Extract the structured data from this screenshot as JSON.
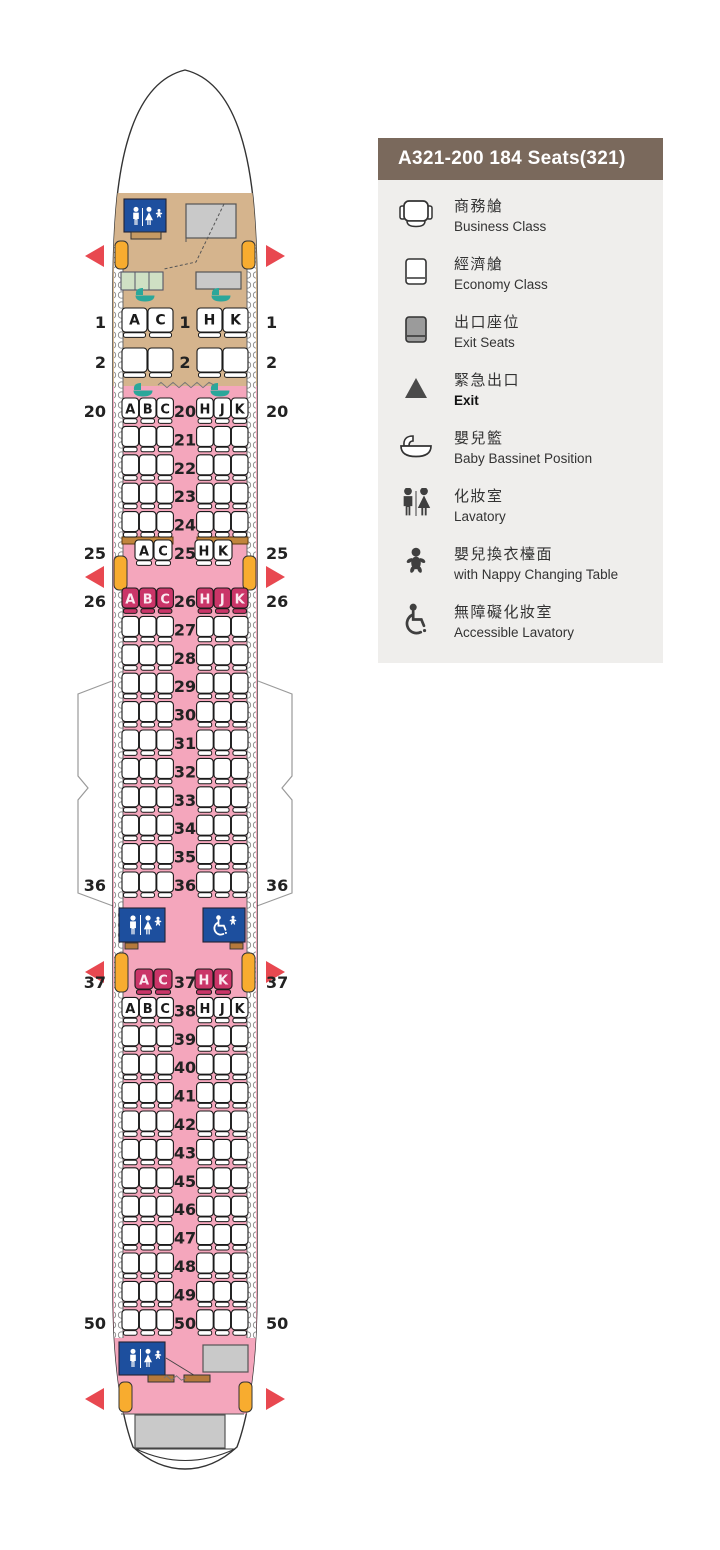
{
  "header": {
    "title": "A321-200 184 Seats(321)"
  },
  "colors": {
    "header_bg": "#7a695c",
    "legend_bg": "#efeeec",
    "pink": "#f4a6bc",
    "magenta": "#ca3568",
    "magenta_letter": "#fbe9f0",
    "tan": "#d5b48d",
    "tan_shelf": "#c59a63",
    "blue": "#1d4f9e",
    "orange": "#f8ac2f",
    "red": "#e84850",
    "teal": "#2ba79a",
    "green": "#cfe0c4",
    "gray": "#c9c9c9",
    "exit_seat_gray": "#9b9b9b",
    "brown_bar": "#b5793b",
    "bulkhead": "#c1853c",
    "outline": "#333333",
    "seat_stroke": "#1a1a1a",
    "number": "#222222",
    "wing": "#9a9a9a",
    "wall": "#888888"
  },
  "legend": {
    "items": [
      {
        "id": "business-class",
        "icon": "business-seat",
        "zh": "商務艙",
        "en": "Business Class"
      },
      {
        "id": "economy-class",
        "icon": "economy-seat",
        "zh": "經濟艙",
        "en": "Economy Class"
      },
      {
        "id": "exit-seats",
        "icon": "exit-seat",
        "zh": "出口座位",
        "en": "Exit Seats"
      },
      {
        "id": "exit",
        "icon": "exit-triangle",
        "zh": "緊急出口",
        "en": "Exit",
        "bold": true
      },
      {
        "id": "baby-bassinet",
        "icon": "bassinet",
        "zh": "嬰兒籃",
        "en": "Baby Bassinet Position"
      },
      {
        "id": "lavatory",
        "icon": "lavatory",
        "zh": "化妝室",
        "en": "Lavatory"
      },
      {
        "id": "nappy-changing",
        "icon": "nappy",
        "zh": "嬰兒換衣檯面",
        "en": "with Nappy Changing Table"
      },
      {
        "id": "accessible-lavatory",
        "icon": "accessible-lavatory",
        "zh": "無障礙化妝室",
        "en": "Accessible Lavatory"
      }
    ]
  },
  "seatmap": {
    "aircraft": "A321-200",
    "total_seats": "184",
    "business": {
      "rows": [
        {
          "n": "1",
          "left": [
            "A",
            "C"
          ],
          "right": [
            "H",
            "K"
          ],
          "side": true
        },
        {
          "n": "2",
          "left": [],
          "right": [],
          "side": true
        }
      ]
    },
    "economy": {
      "rows": [
        {
          "n": "20",
          "left": [
            "A",
            "B",
            "C"
          ],
          "right": [
            "H",
            "J",
            "K"
          ],
          "side": true,
          "cfg": "triple",
          "color": "white"
        },
        {
          "n": "21"
        },
        {
          "n": "22"
        },
        {
          "n": "23"
        },
        {
          "n": "24"
        },
        {
          "n": "25",
          "left": [
            "A",
            "C"
          ],
          "right": [
            "H",
            "K"
          ],
          "side": true,
          "cfg": "pair",
          "color": "white"
        },
        {
          "n": "26",
          "left": [
            "A",
            "B",
            "C"
          ],
          "right": [
            "H",
            "J",
            "K"
          ],
          "side": true,
          "cfg": "triple",
          "color": "magenta"
        },
        {
          "n": "27"
        },
        {
          "n": "28"
        },
        {
          "n": "29"
        },
        {
          "n": "30"
        },
        {
          "n": "31"
        },
        {
          "n": "32"
        },
        {
          "n": "33"
        },
        {
          "n": "34"
        },
        {
          "n": "35"
        },
        {
          "n": "36",
          "side": true
        },
        {
          "n": "37",
          "left": [
            "A",
            "C"
          ],
          "right": [
            "H",
            "K"
          ],
          "side": true,
          "cfg": "pair",
          "color": "magenta"
        },
        {
          "n": "38",
          "left": [
            "A",
            "B",
            "C"
          ],
          "right": [
            "H",
            "J",
            "K"
          ],
          "cfg": "triple",
          "color": "white"
        },
        {
          "n": "39"
        },
        {
          "n": "40"
        },
        {
          "n": "41"
        },
        {
          "n": "42"
        },
        {
          "n": "43"
        },
        {
          "n": "45"
        },
        {
          "n": "46"
        },
        {
          "n": "47"
        },
        {
          "n": "48"
        },
        {
          "n": "49"
        },
        {
          "n": "50",
          "side": true
        }
      ]
    }
  }
}
